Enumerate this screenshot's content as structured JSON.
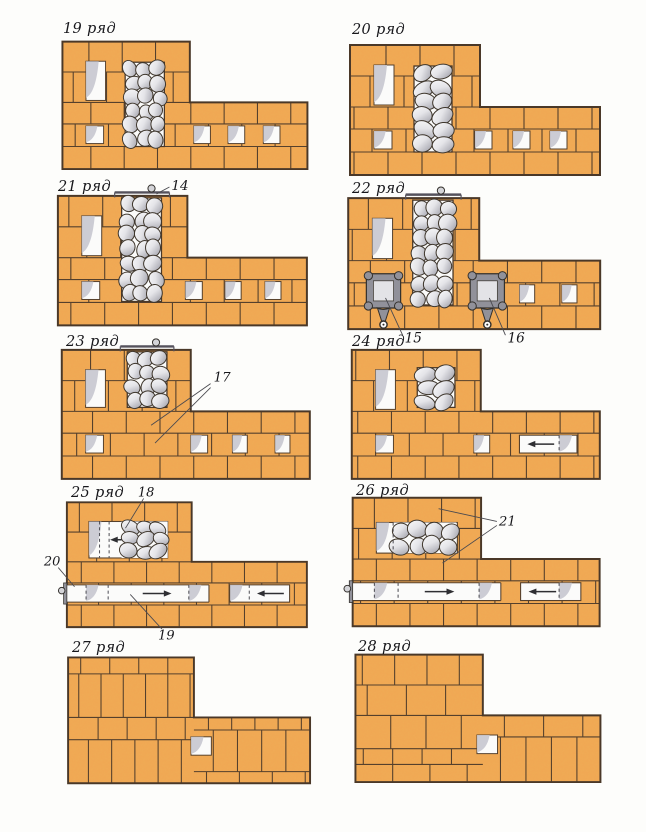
{
  "page": {
    "kind": "masonry-course-diagrams",
    "rows_shown": [
      "19",
      "20",
      "21",
      "22",
      "23",
      "24",
      "25",
      "26",
      "27",
      "28"
    ]
  },
  "colors": {
    "pageBg": "#fdfdfb",
    "brick": "#f2a853",
    "brickEdge": "#4a3828",
    "joint": "#55402c",
    "white": "#fbfbfa",
    "openingShade": "#c6c6cf",
    "stoneStroke": "#3e362c",
    "metal": "#91919a",
    "metalLight": "#d4d4d8",
    "ink": "#17171b",
    "leader": "#4a4a50",
    "arrow": "#2e2e32",
    "dash": "#55555c"
  },
  "outline": "M0,0 H130 V62 H250 V130 H0 Z",
  "standardBands": [
    [
      0,
      31,
      0,
      130,
      34,
      18
    ],
    [
      31,
      62,
      0,
      130,
      34,
      2
    ],
    [
      62,
      84,
      0,
      250,
      34,
      20
    ],
    [
      84,
      107,
      0,
      250,
      34,
      4
    ],
    [
      107,
      130,
      0,
      250,
      34,
      20
    ]
  ],
  "diagrams": [
    {
      "id": "19",
      "label": "19 ряд",
      "x": 62,
      "y": 42,
      "w": 245,
      "labelX": 63,
      "labelY": 21,
      "seed": 1,
      "bands": "std",
      "stones": [
        {
          "x": 64,
          "y": 21,
          "w": 40,
          "h": 86,
          "border": true
        }
      ],
      "openings": [
        [
          24,
          20,
          20,
          40
        ],
        [
          24,
          86,
          18,
          18
        ],
        [
          134,
          86,
          17,
          18
        ],
        [
          169,
          86,
          17,
          18
        ],
        [
          205,
          86,
          17,
          18
        ]
      ]
    },
    {
      "id": "20",
      "label": "20 ряд",
      "x": 350,
      "y": 45,
      "w": 250,
      "labelX": 352,
      "labelY": 22,
      "seed": 2,
      "bands": "std",
      "stones": [
        {
          "x": 64,
          "y": 21,
          "w": 38,
          "h": 86,
          "border": true
        }
      ],
      "openings": [
        [
          24,
          20,
          20,
          40
        ],
        [
          24,
          86,
          18,
          18
        ],
        [
          125,
          86,
          17,
          18
        ],
        [
          163,
          86,
          17,
          18
        ],
        [
          200,
          86,
          17,
          18
        ]
      ]
    },
    {
      "id": "21",
      "label": "21 ряд",
      "x": 58,
      "y": 196,
      "w": 249,
      "labelX": 58,
      "labelY": 179,
      "seed": 3,
      "bands": "std",
      "stones": [
        {
          "x": 64,
          "y": 2,
          "w": 40,
          "h": 104,
          "border": true
        }
      ],
      "openings": [
        [
          24,
          20,
          20,
          40
        ],
        [
          24,
          86,
          18,
          18
        ],
        [
          128,
          86,
          17,
          18
        ],
        [
          168,
          86,
          16,
          18
        ],
        [
          208,
          86,
          16,
          18
        ]
      ],
      "bar": {
        "x1": 57,
        "x2": 112,
        "knob": 94
      },
      "callouts": [
        {
          "text": "14",
          "tx": 114,
          "ty": -6,
          "lines": [
            [
              112,
              -9,
              99,
              -2
            ]
          ]
        }
      ]
    },
    {
      "id": "22",
      "label": "22 ряд",
      "x": 348,
      "y": 198,
      "w": 252,
      "labelX": 352,
      "labelY": 181,
      "seed": 4,
      "bands": "std",
      "stones": [
        {
          "x": 64,
          "y": 2,
          "w": 40,
          "h": 104,
          "border": true
        }
      ],
      "openings": [
        [
          24,
          20,
          20,
          40
        ],
        [
          170,
          86,
          15,
          18
        ],
        [
          212,
          86,
          15,
          18
        ]
      ],
      "bar": {
        "x1": 57,
        "x2": 112,
        "knob": 92
      },
      "doors": [
        [
          35,
          92
        ],
        [
          138,
          92
        ]
      ],
      "callouts": [
        {
          "text": "15",
          "tx": 56,
          "ty": 143,
          "lines": [
            [
              54,
              136,
              37,
              99
            ]
          ]
        },
        {
          "text": "16",
          "tx": 158,
          "ty": 143,
          "lines": [
            [
              156,
              136,
              140,
              99
            ]
          ]
        }
      ]
    },
    {
      "id": "23",
      "label": "23 ряд",
      "x": 62,
      "y": 350,
      "w": 248,
      "labelX": 66,
      "labelY": 334,
      "seed": 5,
      "bands": "std",
      "stones": [
        {
          "x": 66,
          "y": 2,
          "w": 40,
          "h": 56,
          "border": true
        }
      ],
      "openings": [
        [
          24,
          20,
          20,
          38
        ],
        [
          24,
          86,
          18,
          18
        ],
        [
          130,
          86,
          17,
          18
        ],
        [
          172,
          86,
          15,
          18
        ],
        [
          215,
          86,
          15,
          18
        ]
      ],
      "bar": {
        "x1": 59,
        "x2": 113,
        "knob": 95
      },
      "callouts": [
        {
          "text": "17",
          "tx": 153,
          "ty": 32,
          "lines": [
            [
              150,
              34,
              90,
              76
            ],
            [
              150,
              38,
              94,
              94
            ]
          ]
        }
      ]
    },
    {
      "id": "24",
      "label": "24 ряд",
      "x": 352,
      "y": 350,
      "w": 248,
      "labelX": 352,
      "labelY": 334,
      "seed": 6,
      "bands": "std",
      "stones": [
        {
          "x": 66,
          "y": 18,
          "w": 38,
          "h": 40,
          "border": true
        }
      ],
      "openings": [
        [
          24,
          20,
          20,
          40
        ],
        [
          24,
          86,
          18,
          18
        ],
        [
          123,
          86,
          16,
          18
        ]
      ],
      "whiteAreas": [
        [
          169,
          86,
          58,
          18,
          "box"
        ]
      ],
      "dashes": [
        [
          209,
          86,
          104
        ]
      ],
      "arrows": [
        [
          204,
          177,
          95
        ]
      ],
      "shades": [
        [
          209,
          86,
          18
        ]
      ]
    },
    {
      "id": "25",
      "label": "25 ряд",
      "x": 67,
      "y": 502,
      "w": 240,
      "labelX": 71,
      "labelY": 485,
      "seed": 7,
      "bands": "std",
      "stones": [
        {
          "x": 57,
          "y": 20,
          "w": 48,
          "h": 38,
          "border": false
        }
      ],
      "whiteAreas": [
        [
          23,
          20,
          82,
          38,
          "box"
        ],
        [
          -1,
          86,
          149,
          18,
          "open"
        ],
        [
          170,
          86,
          62,
          18,
          "box"
        ]
      ],
      "dashes": [
        [
          34,
          20,
          58
        ],
        [
          44,
          20,
          58
        ],
        [
          20,
          86,
          104
        ],
        [
          43,
          86,
          104
        ],
        [
          127,
          86,
          104
        ],
        [
          190,
          86,
          104
        ]
      ],
      "arrows": [
        [
          57,
          45,
          39
        ],
        [
          79,
          109,
          95
        ],
        [
          226,
          198,
          95
        ]
      ],
      "shades": [
        [
          23,
          20,
          38
        ],
        [
          20,
          86,
          18
        ],
        [
          127,
          86,
          18
        ],
        [
          170,
          86,
          18
        ]
      ],
      "valve": true,
      "callouts": [
        {
          "text": "18",
          "tx": 74,
          "ty": -6,
          "lines": [
            [
              80,
              -4,
              61,
              27
            ]
          ]
        },
        {
          "text": "20",
          "tx": -24,
          "ty": 66,
          "lines": [
            [
              -9,
              68,
              8,
              88
            ]
          ]
        },
        {
          "text": "19",
          "tx": 95,
          "ty": 143,
          "lines": [
            [
              99,
              132,
              66,
              96
            ]
          ]
        }
      ]
    },
    {
      "id": "26",
      "label": "26 ряд",
      "x": 353,
      "y": 498,
      "w": 247,
      "labelX": 356,
      "labelY": 483,
      "seed": 8,
      "bands": "std",
      "stones": [
        {
          "x": 41,
          "y": 25,
          "w": 64,
          "h": 31,
          "border": false
        }
      ],
      "whiteAreas": [
        [
          24,
          25,
          82,
          31,
          "box"
        ],
        [
          -1,
          86,
          151,
          18,
          "open"
        ],
        [
          170,
          86,
          61,
          18,
          "box"
        ]
      ],
      "dashes": [
        [
          41,
          25,
          56
        ],
        [
          22,
          86,
          104
        ],
        [
          46,
          86,
          104
        ],
        [
          128,
          86,
          104
        ],
        [
          209,
          86,
          104
        ]
      ],
      "arrows": [
        [
          73,
          103,
          95
        ],
        [
          206,
          178,
          95
        ]
      ],
      "shades": [
        [
          24,
          25,
          31
        ],
        [
          22,
          86,
          18
        ],
        [
          128,
          86,
          18
        ],
        [
          209,
          86,
          18
        ]
      ],
      "valve": true,
      "callouts": [
        {
          "text": "21",
          "tx": 148,
          "ty": 28,
          "lines": [
            [
              146,
              24,
              87,
              11
            ],
            [
              146,
              28,
              91,
              66
            ]
          ]
        }
      ]
    },
    {
      "id": "27",
      "label": "27 ряд",
      "x": 68,
      "y": 657,
      "w": 242,
      "labelX": 72,
      "labelY": 640,
      "seed": 9,
      "bands": [
        [
          0,
          17,
          0,
          130,
          30,
          22
        ],
        [
          17,
          62,
          0,
          130,
          23,
          22
        ],
        [
          62,
          85,
          0,
          130,
          30,
          10
        ],
        [
          85,
          130,
          0,
          130,
          24,
          12
        ],
        [
          62,
          75,
          130,
          250,
          24,
          6
        ],
        [
          75,
          118,
          130,
          250,
          25,
          14
        ],
        [
          118,
          130,
          130,
          250,
          34,
          0
        ]
      ],
      "openings": [
        [
          127,
          82,
          21,
          19
        ]
      ]
    },
    {
      "id": "28",
      "label": "28 ряд",
      "x": 355,
      "y": 655,
      "w": 245,
      "labelX": 358,
      "labelY": 639,
      "seed": 10,
      "bands": [
        [
          0,
          31,
          0,
          130,
          33,
          16
        ],
        [
          31,
          62,
          0,
          130,
          40,
          2
        ],
        [
          62,
          96,
          0,
          130,
          36,
          18
        ],
        [
          96,
          112,
          0,
          130,
          30,
          8
        ],
        [
          112,
          130,
          0,
          130,
          38,
          24
        ],
        [
          62,
          84,
          130,
          250,
          40,
          12
        ],
        [
          84,
          130,
          130,
          250,
          26,
          6
        ]
      ],
      "openings": [
        [
          124,
          82,
          21,
          19
        ]
      ]
    }
  ]
}
